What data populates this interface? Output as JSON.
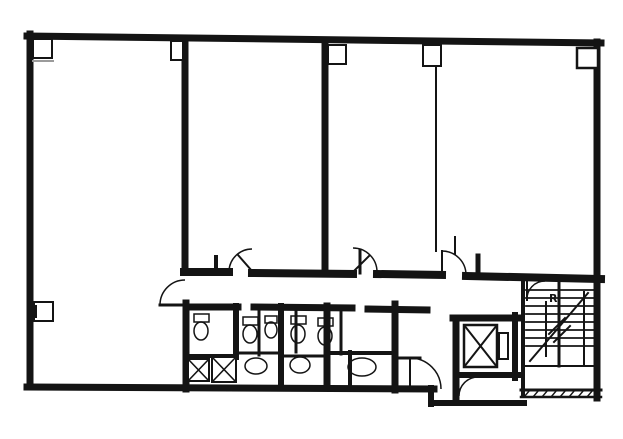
{
  "meta": {
    "title": "scanned-building-floor-plan",
    "width": 623,
    "height": 439
  },
  "palette": {
    "ink": "#141414",
    "paper": "#ffffff",
    "soft": "#9b9b9b"
  },
  "labels": {
    "stair_mark": "R"
  },
  "plan": {
    "elements": [
      {
        "t": "line",
        "name": "top-outer-wall",
        "x1": 27,
        "y1": 36,
        "x2": 601,
        "y2": 43,
        "w": 7
      },
      {
        "t": "line",
        "name": "left-outer-wall",
        "x1": 30,
        "y1": 34,
        "x2": 30,
        "y2": 387,
        "w": 7
      },
      {
        "t": "line",
        "name": "right-outer-wall",
        "x1": 597,
        "y1": 42,
        "x2": 597,
        "y2": 398,
        "w": 7
      },
      {
        "t": "line",
        "name": "bottom-outer-wall",
        "x1": 27,
        "y1": 387,
        "x2": 434,
        "y2": 389,
        "w": 7
      },
      {
        "t": "line",
        "name": "partition-wall-left-upper",
        "x1": 185,
        "y1": 38,
        "x2": 185,
        "y2": 272,
        "w": 7
      },
      {
        "t": "line",
        "name": "partition-wall-left-lower",
        "x1": 186,
        "y1": 303,
        "x2": 186,
        "y2": 389,
        "w": 7
      },
      {
        "t": "line",
        "name": "partition-wall-center",
        "x1": 325,
        "y1": 41,
        "x2": 325,
        "y2": 272,
        "w": 7
      },
      {
        "t": "line",
        "name": "partition-wall-thin",
        "x1": 436,
        "y1": 66,
        "x2": 436,
        "y2": 251,
        "w": 2
      },
      {
        "t": "line",
        "name": "corridor-top-wall-a",
        "x1": 184,
        "y1": 272,
        "x2": 229,
        "y2": 272,
        "w": 8
      },
      {
        "t": "line",
        "name": "corridor-top-wall-b",
        "x1": 252,
        "y1": 273,
        "x2": 353,
        "y2": 274,
        "w": 8
      },
      {
        "t": "line",
        "name": "corridor-top-wall-c",
        "x1": 377,
        "y1": 274,
        "x2": 442,
        "y2": 275,
        "w": 8
      },
      {
        "t": "line",
        "name": "corridor-top-wall-d",
        "x1": 466,
        "y1": 276,
        "x2": 601,
        "y2": 279,
        "w": 8
      },
      {
        "t": "line",
        "name": "corridor-bottom-wall-a",
        "x1": 186,
        "y1": 307,
        "x2": 238,
        "y2": 307,
        "w": 7
      },
      {
        "t": "line",
        "name": "corridor-bottom-wall-b",
        "x1": 254,
        "y1": 307,
        "x2": 352,
        "y2": 308,
        "w": 7
      },
      {
        "t": "line",
        "name": "corridor-bottom-wall-c",
        "x1": 368,
        "y1": 309,
        "x2": 427,
        "y2": 310,
        "w": 7
      },
      {
        "t": "line",
        "name": "elevator-shaft-top-wall",
        "x1": 453,
        "y1": 318,
        "x2": 518,
        "y2": 318,
        "w": 7
      },
      {
        "t": "line",
        "name": "elevator-shaft-left-wall",
        "x1": 456,
        "y1": 318,
        "x2": 456,
        "y2": 401,
        "w": 7
      },
      {
        "t": "line",
        "name": "elevator-shaft-right-wall",
        "x1": 515,
        "y1": 315,
        "x2": 515,
        "y2": 378,
        "w": 6
      },
      {
        "t": "line",
        "name": "stairwell-left-wall",
        "x1": 523,
        "y1": 279,
        "x2": 523,
        "y2": 395,
        "w": 4
      },
      {
        "t": "line",
        "name": "below-shaft-wall",
        "x1": 456,
        "y1": 375,
        "x2": 518,
        "y2": 375,
        "w": 6
      },
      {
        "t": "line",
        "name": "protrusion-left-wall",
        "x1": 431,
        "y1": 388,
        "x2": 431,
        "y2": 404,
        "w": 6
      },
      {
        "t": "line",
        "name": "protrusion-bottom-wall",
        "x1": 431,
        "y1": 403,
        "x2": 524,
        "y2": 403,
        "w": 6
      },
      {
        "t": "line",
        "name": "stair-bottom-wall",
        "x1": 521,
        "y1": 390,
        "x2": 601,
        "y2": 390,
        "w": 3
      },
      {
        "t": "line",
        "name": "stair-bottom-wall-outer",
        "x1": 521,
        "y1": 397,
        "x2": 601,
        "y2": 397,
        "w": 2.5
      },
      {
        "t": "line",
        "name": "toilet-partition-1",
        "x1": 236,
        "y1": 306,
        "x2": 236,
        "y2": 357,
        "w": 6
      },
      {
        "t": "line",
        "name": "toilet-partition-2",
        "x1": 259,
        "y1": 309,
        "x2": 259,
        "y2": 355,
        "w": 3
      },
      {
        "t": "line",
        "name": "toilet-partition-3",
        "x1": 281,
        "y1": 306,
        "x2": 281,
        "y2": 388,
        "w": 6
      },
      {
        "t": "line",
        "name": "toilet-partition-4",
        "x1": 296,
        "y1": 309,
        "x2": 296,
        "y2": 352,
        "w": 3
      },
      {
        "t": "line",
        "name": "toilet-partition-5",
        "x1": 327,
        "y1": 306,
        "x2": 327,
        "y2": 388,
        "w": 7
      },
      {
        "t": "line",
        "name": "toilet-partition-6",
        "x1": 341,
        "y1": 309,
        "x2": 341,
        "y2": 354,
        "w": 3
      },
      {
        "t": "line",
        "name": "toilet-partition-7",
        "x1": 350,
        "y1": 352,
        "x2": 350,
        "y2": 388,
        "w": 4
      },
      {
        "t": "line",
        "name": "hall-left-wall",
        "x1": 395,
        "y1": 304,
        "x2": 395,
        "y2": 390,
        "w": 7
      },
      {
        "t": "line",
        "name": "toilet-cross-wall-1",
        "x1": 186,
        "y1": 356,
        "x2": 236,
        "y2": 356,
        "w": 4
      },
      {
        "t": "line",
        "name": "toilet-cross-wall-2",
        "x1": 236,
        "y1": 353,
        "x2": 281,
        "y2": 353,
        "w": 3
      },
      {
        "t": "line",
        "name": "toilet-cross-wall-3",
        "x1": 281,
        "y1": 356,
        "x2": 327,
        "y2": 356,
        "w": 3
      },
      {
        "t": "line",
        "name": "toilet-cross-wall-4",
        "x1": 327,
        "y1": 353,
        "x2": 395,
        "y2": 353,
        "w": 4
      },
      {
        "t": "line",
        "name": "hall-stub-wall",
        "x1": 395,
        "y1": 358,
        "x2": 420,
        "y2": 358,
        "w": 3
      },
      {
        "t": "line",
        "name": "door-stub-1",
        "x1": 216,
        "y1": 257,
        "x2": 216,
        "y2": 272,
        "w": 4
      },
      {
        "t": "line",
        "name": "door-stub-2",
        "x1": 360,
        "y1": 250,
        "x2": 360,
        "y2": 273,
        "w": 3
      },
      {
        "t": "line",
        "name": "door-stub-3",
        "x1": 455,
        "y1": 237,
        "x2": 455,
        "y2": 254,
        "w": 2
      },
      {
        "t": "line",
        "name": "door-stub-4",
        "x1": 478,
        "y1": 256,
        "x2": 478,
        "y2": 275,
        "w": 5
      },
      {
        "t": "rect",
        "name": "corner-column-box-left",
        "x": 33,
        "y": 39,
        "width": 19,
        "height": 19,
        "w": 2,
        "f": "paper"
      },
      {
        "t": "rect",
        "name": "column-box-1",
        "x": 171,
        "y": 41,
        "width": 12,
        "height": 19,
        "w": 2,
        "f": "paper"
      },
      {
        "t": "rect",
        "name": "column-box-2",
        "x": 328,
        "y": 45,
        "width": 18,
        "height": 19,
        "w": 2,
        "f": "paper"
      },
      {
        "t": "rect",
        "name": "column-box-3",
        "x": 423,
        "y": 45,
        "width": 18,
        "height": 21,
        "w": 2,
        "f": "paper"
      },
      {
        "t": "rect",
        "name": "corner-column-box-right",
        "x": 577,
        "y": 48,
        "width": 21,
        "height": 20,
        "w": 2.5,
        "f": "paper"
      },
      {
        "t": "rect",
        "name": "left-wall-pilaster-box",
        "x": 34,
        "y": 302,
        "width": 19,
        "height": 19,
        "w": 2,
        "f": "paper"
      },
      {
        "t": "line",
        "name": "corner-box-underline",
        "x1": 33,
        "y1": 61,
        "x2": 53,
        "y2": 61,
        "w": 2,
        "c": "soft"
      },
      {
        "t": "line",
        "name": "pilaster-inner-line",
        "x1": 36,
        "y1": 306,
        "x2": 36,
        "y2": 317,
        "w": 2
      },
      {
        "t": "xbox",
        "name": "pipe-shaft-box-1",
        "x": 188,
        "y": 359,
        "width": 21,
        "height": 22,
        "w": 2
      },
      {
        "t": "xbox",
        "name": "pipe-shaft-box-2",
        "x": 212,
        "y": 357,
        "width": 24,
        "height": 25,
        "w": 2
      },
      {
        "t": "xbox",
        "name": "elevator-car",
        "x": 464,
        "y": 325,
        "width": 33,
        "height": 42,
        "w": 2.5
      },
      {
        "t": "rect",
        "name": "elevator-door-bar",
        "x": 499,
        "y": 333,
        "width": 9,
        "height": 26,
        "w": 2
      },
      {
        "t": "rect",
        "name": "toilet-tank-1",
        "x": 194,
        "y": 314,
        "width": 15,
        "height": 8,
        "w": 1.5
      },
      {
        "t": "rect",
        "name": "toilet-tank-2",
        "x": 243,
        "y": 317,
        "width": 15,
        "height": 8,
        "w": 1.5
      },
      {
        "t": "rect",
        "name": "toilet-tank-3",
        "x": 265,
        "y": 316,
        "width": 12,
        "height": 7,
        "w": 1.5
      },
      {
        "t": "rect",
        "name": "toilet-tank-4",
        "x": 291,
        "y": 316,
        "width": 15,
        "height": 8,
        "w": 1.5
      },
      {
        "t": "rect",
        "name": "toilet-tank-5",
        "x": 318,
        "y": 318,
        "width": 15,
        "height": 8,
        "w": 1.5
      },
      {
        "t": "ellipse",
        "name": "toilet-bowl-1",
        "cx": 201,
        "cy": 331,
        "rx": 7,
        "ry": 9,
        "w": 1.5
      },
      {
        "t": "ellipse",
        "name": "toilet-bowl-2",
        "cx": 250,
        "cy": 334,
        "rx": 7,
        "ry": 9,
        "w": 1.5
      },
      {
        "t": "ellipse",
        "name": "toilet-bowl-3",
        "cx": 271,
        "cy": 330,
        "rx": 6,
        "ry": 8,
        "w": 1.5
      },
      {
        "t": "ellipse",
        "name": "toilet-bowl-4",
        "cx": 298,
        "cy": 334,
        "rx": 7,
        "ry": 9,
        "w": 1.5
      },
      {
        "t": "ellipse",
        "name": "toilet-bowl-5",
        "cx": 325,
        "cy": 336,
        "rx": 7,
        "ry": 9,
        "w": 1.5
      },
      {
        "t": "ellipse",
        "name": "sink-counter-1",
        "cx": 256,
        "cy": 366,
        "rx": 11,
        "ry": 8,
        "w": 1.5
      },
      {
        "t": "ellipse",
        "name": "sink-counter-2",
        "cx": 300,
        "cy": 365,
        "rx": 10,
        "ry": 8,
        "w": 1.5
      },
      {
        "t": "ellipse",
        "name": "sink-counter-3",
        "cx": 362,
        "cy": 367,
        "rx": 14,
        "ry": 9,
        "w": 1.5
      },
      {
        "t": "path",
        "name": "door-swing-corridor-to-left-room",
        "d": "M160,305 A25,25 0 0 1 185,280",
        "w": 1.5
      },
      {
        "t": "line",
        "name": "door-leaf-corridor-to-left-room",
        "x1": 160,
        "y1": 305,
        "x2": 185,
        "y2": 305,
        "w": 3
      },
      {
        "t": "path",
        "name": "door-swing-middle-room",
        "d": "M229,271 A23,23 0 0 1 252,249",
        "w": 1.5
      },
      {
        "t": "line",
        "name": "door-leaf-middle-room",
        "x1": 252,
        "y1": 271,
        "x2": 238,
        "y2": 255,
        "w": 2
      },
      {
        "t": "path",
        "name": "door-swing-right-room-1",
        "d": "M377,272 A24,24 0 0 0 353,248",
        "w": 1.5
      },
      {
        "t": "line",
        "name": "door-leaf-right-room-1",
        "x1": 353,
        "y1": 272,
        "x2": 369,
        "y2": 256,
        "w": 2
      },
      {
        "t": "path",
        "name": "door-swing-right-room-2",
        "d": "M442,251 A24,24 0 0 1 466,275",
        "w": 1.5
      },
      {
        "t": "line",
        "name": "door-leaf-right-room-2",
        "x1": 442,
        "y1": 251,
        "x2": 442,
        "y2": 274,
        "w": 2
      },
      {
        "t": "path",
        "name": "door-swing-elevator-hall",
        "d": "M410,358 A31,31 0 0 1 441,389",
        "w": 1.5
      },
      {
        "t": "line",
        "name": "door-leaf-elevator-hall",
        "x1": 410,
        "y1": 358,
        "x2": 410,
        "y2": 389,
        "w": 2
      },
      {
        "t": "path",
        "name": "door-swing-below-shaft",
        "d": "M459,396 A19,19 0 0 1 478,377",
        "w": 1.5
      },
      {
        "t": "path",
        "name": "door-swing-stairwell",
        "d": "M527,300 A18,18 0 0 1 545,281",
        "w": 1.5
      },
      {
        "t": "line",
        "name": "door-leaf-stairwell",
        "x1": 527,
        "y1": 281,
        "x2": 527,
        "y2": 300,
        "w": 2
      },
      {
        "t": "line",
        "name": "stair-divider",
        "x1": 559,
        "y1": 283,
        "x2": 559,
        "y2": 366,
        "w": 3
      },
      {
        "t": "line",
        "name": "stair-divider-2",
        "x1": 546,
        "y1": 302,
        "x2": 546,
        "y2": 356,
        "w": 2
      },
      {
        "t": "line",
        "name": "stair-divider-3",
        "x1": 584,
        "y1": 292,
        "x2": 584,
        "y2": 364,
        "w": 2
      },
      {
        "t": "line",
        "name": "stair-tread",
        "x1": 526,
        "y1": 290,
        "x2": 593,
        "y2": 290,
        "w": 1.8
      },
      {
        "t": "line",
        "name": "stair-tread",
        "x1": 526,
        "y1": 298,
        "x2": 593,
        "y2": 298,
        "w": 1.8
      },
      {
        "t": "line",
        "name": "stair-tread",
        "x1": 526,
        "y1": 306,
        "x2": 593,
        "y2": 306,
        "w": 1.8
      },
      {
        "t": "line",
        "name": "stair-tread",
        "x1": 526,
        "y1": 314,
        "x2": 593,
        "y2": 314,
        "w": 1.8
      },
      {
        "t": "line",
        "name": "stair-tread",
        "x1": 526,
        "y1": 322,
        "x2": 593,
        "y2": 322,
        "w": 1.8
      },
      {
        "t": "line",
        "name": "stair-tread",
        "x1": 526,
        "y1": 330,
        "x2": 593,
        "y2": 330,
        "w": 1.8
      },
      {
        "t": "line",
        "name": "stair-tread",
        "x1": 526,
        "y1": 338,
        "x2": 593,
        "y2": 338,
        "w": 1.8
      },
      {
        "t": "line",
        "name": "stair-tread",
        "x1": 526,
        "y1": 346,
        "x2": 593,
        "y2": 346,
        "w": 1.8
      },
      {
        "t": "line",
        "name": "stair-landing-line",
        "x1": 526,
        "y1": 366,
        "x2": 594,
        "y2": 366,
        "w": 2
      },
      {
        "t": "line",
        "name": "stair-direction-line",
        "x1": 530,
        "y1": 361,
        "x2": 588,
        "y2": 293,
        "w": 2
      },
      {
        "t": "line",
        "name": "stair-break-slash-1",
        "x1": 549,
        "y1": 334,
        "x2": 565,
        "y2": 318,
        "w": 2
      },
      {
        "t": "line",
        "name": "stair-break-slash-2",
        "x1": 554,
        "y1": 342,
        "x2": 570,
        "y2": 326,
        "w": 2
      },
      {
        "t": "line",
        "name": "wall-hatch",
        "x1": 524,
        "y1": 397,
        "x2": 530,
        "y2": 390,
        "w": 1.5
      },
      {
        "t": "line",
        "name": "wall-hatch",
        "x1": 533,
        "y1": 397,
        "x2": 539,
        "y2": 390,
        "w": 1.5
      },
      {
        "t": "line",
        "name": "wall-hatch",
        "x1": 542,
        "y1": 397,
        "x2": 548,
        "y2": 390,
        "w": 1.5
      },
      {
        "t": "line",
        "name": "wall-hatch",
        "x1": 551,
        "y1": 397,
        "x2": 557,
        "y2": 390,
        "w": 1.5
      },
      {
        "t": "line",
        "name": "wall-hatch",
        "x1": 560,
        "y1": 397,
        "x2": 566,
        "y2": 390,
        "w": 1.5
      },
      {
        "t": "line",
        "name": "wall-hatch",
        "x1": 569,
        "y1": 397,
        "x2": 575,
        "y2": 390,
        "w": 1.5
      },
      {
        "t": "line",
        "name": "wall-hatch",
        "x1": 578,
        "y1": 397,
        "x2": 584,
        "y2": 390,
        "w": 1.5
      },
      {
        "t": "line",
        "name": "wall-hatch",
        "x1": 587,
        "y1": 397,
        "x2": 593,
        "y2": 390,
        "w": 1.5
      },
      {
        "t": "text",
        "name": "stair-level-mark",
        "text": "R",
        "x": 549,
        "y": 302,
        "size": 11,
        "weight": "bold"
      }
    ]
  }
}
